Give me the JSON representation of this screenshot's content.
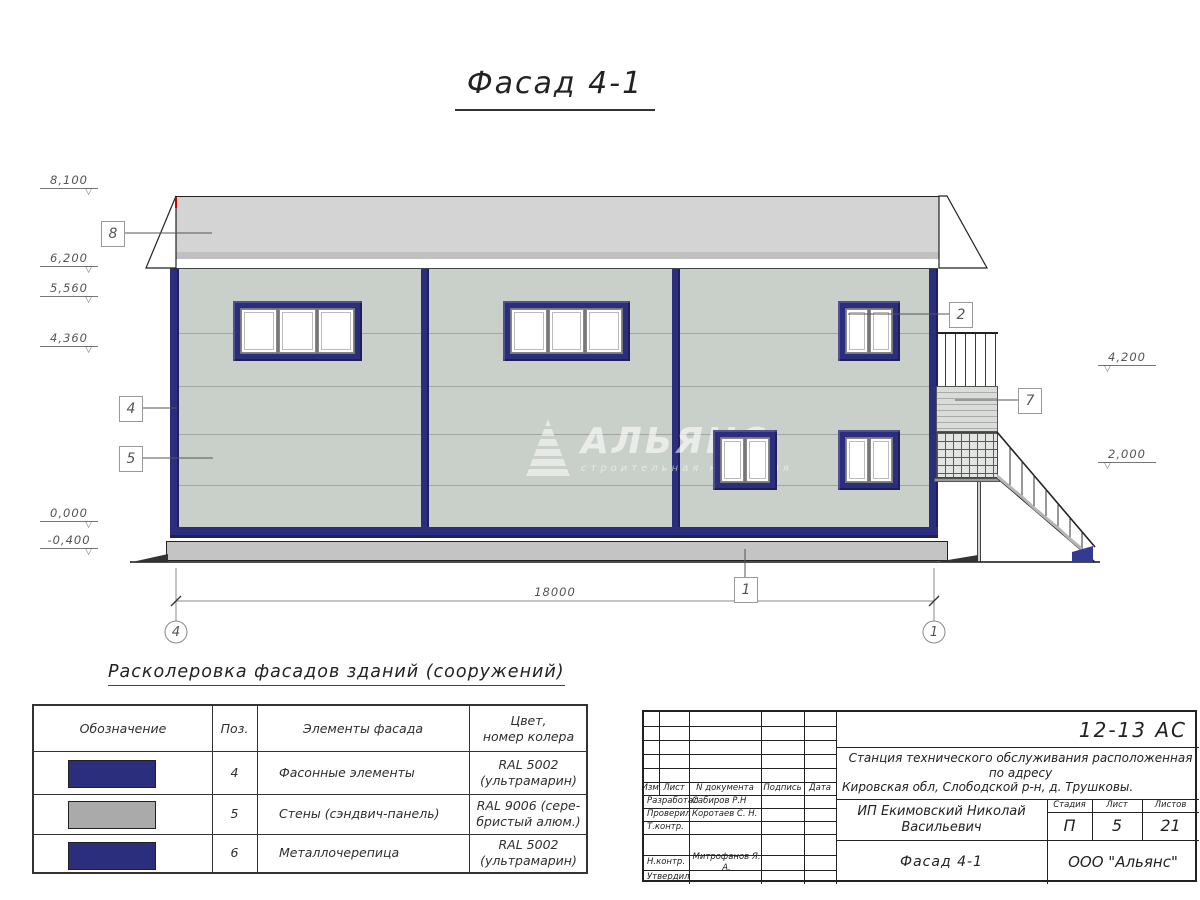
{
  "title": "Фасад 4-1",
  "drawing": {
    "levels_left": [
      "8,100",
      "6,200",
      "5,560",
      "4,360",
      "0,000",
      "-0,400"
    ],
    "levels_right": [
      "4,200",
      "2,000"
    ],
    "callouts": {
      "roof": "8",
      "corner": "4",
      "wall": "5",
      "window": "2",
      "stair": "7",
      "plinth": "1"
    },
    "dimension": "18000",
    "axis_left": "4",
    "axis_right": "1",
    "watermark": {
      "name": "АЛЬЯНС",
      "subtitle": "строительная компания"
    },
    "colors": {
      "navy": "#2b2d7d",
      "wall": "#c9cfc9",
      "roof": "#d3d4d3"
    }
  },
  "legend": {
    "heading": "Расколеровка фасадов зданий (сооружений)",
    "col_designation": "Обозначение",
    "col_pos": "Поз.",
    "col_element": "Элементы фасада",
    "col_color_1": "Цвет,",
    "col_color_2": "номер колера",
    "rows": [
      {
        "pos": "4",
        "element": "Фасонные элементы",
        "color_1": "RAL 5002",
        "color_2": "(ультрамарин)",
        "swatch": "#2b2d7d"
      },
      {
        "pos": "5",
        "element": "Стены (сэндвич-панель)",
        "color_1": "RAL 9006 (сере-",
        "color_2": "бристый алюм.)",
        "swatch": "#a9aaa9"
      },
      {
        "pos": "6",
        "element": "Металлочерепица",
        "color_1": "RAL 5002",
        "color_2": "(ультрамарин)",
        "swatch": "#2b2d7d"
      }
    ]
  },
  "stamp": {
    "doc_number": "12-13 АС",
    "project_line1": "Станция технического обслуживания расположенная по адресу",
    "project_line2": "Кировская обл, Слободской р-н, д. Трушковы.",
    "client": "ИП Екимовский Николай Васильевич",
    "sheet_name": "Фасад 4-1",
    "company": "ООО \"Альянс\"",
    "stage_label": "Стадия",
    "sheet_label": "Лист",
    "sheets_label": "Листов",
    "stage": "П",
    "sheet": "5",
    "sheets": "21",
    "rev": {
      "izm": "Изм.",
      "list": "Лист",
      "doc": "N документа",
      "sign": "Подпись",
      "date": "Дата"
    },
    "signs": [
      {
        "role": "Разработал",
        "name": "Сабиров Р.Н"
      },
      {
        "role": "Проверил",
        "name": "Коротаев С. Н."
      },
      {
        "role": "Т.контр.",
        "name": ""
      },
      {
        "role": "Н.контр.",
        "name": "Митрофанов Я. А."
      },
      {
        "role": "Утвердил",
        "name": ""
      }
    ]
  }
}
